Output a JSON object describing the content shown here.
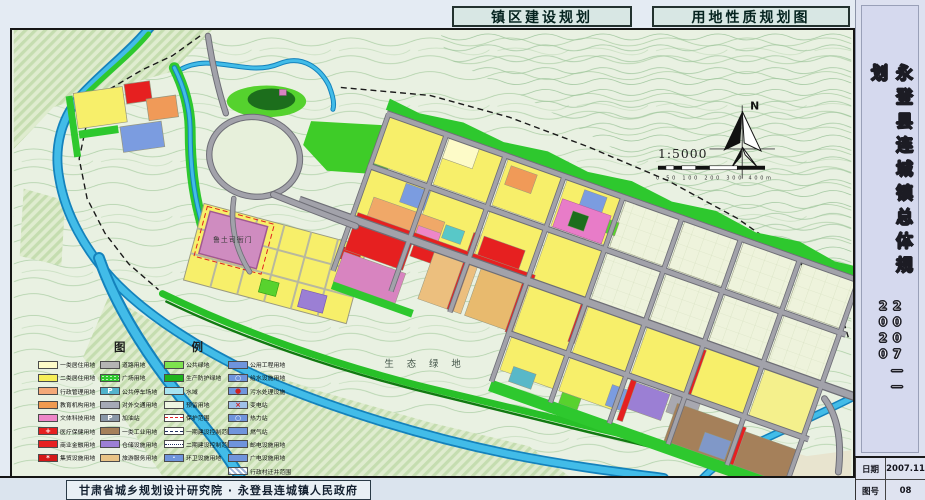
{
  "header": {
    "title_left": "镇区建设规划",
    "title_right": "用地性质规划图"
  },
  "sidebar": {
    "title": "永登县连城镇总体规划",
    "years": "2007——2020",
    "rows": [
      {
        "label": "日期",
        "value": "2007.11"
      },
      {
        "label": "图号",
        "value": "08"
      }
    ]
  },
  "footer": {
    "credit": "甘肃省城乡规划设计研究院 · 永登县连城镇人民政府"
  },
  "map": {
    "landmark_label": "鲁土司衙门",
    "eco_label": "生 态 绿 地",
    "north_label": "N",
    "scale_text": "1:5000",
    "scalebar_labels": "0  50 100    200     300     400m"
  },
  "palette": {
    "water": "#42bce8",
    "road": "#a2a2aa",
    "protective_green": "#2ec82e",
    "residential_yellow": "#f7ef6a",
    "commercial_red": "#e62020",
    "terrain": "#e9f1e2"
  },
  "legend": {
    "title": "图    例",
    "columns": [
      [
        {
          "label": "一类居住用地",
          "color": "#fdfbc8"
        },
        {
          "label": "二类居住用地",
          "color": "#f6ee58"
        },
        {
          "label": "行政管理用地",
          "color": "#f4a878"
        },
        {
          "label": "教育机构用地",
          "color": "#f09a50"
        },
        {
          "label": "文体科技用地",
          "color": "#ee86c8"
        },
        {
          "label": "医疗保健用地",
          "color": "#e62020",
          "sym": "+",
          "symColor": "#ffffff"
        },
        {
          "label": "商业金融用地",
          "color": "#e62020"
        },
        {
          "label": "集贸设施用地",
          "color": "#d41818",
          "sym": "*",
          "symColor": "#ffffff"
        }
      ],
      [
        {
          "label": "道路用地",
          "color": "#b4b4b4"
        },
        {
          "label": "广场用地",
          "color": "#2ec82e",
          "dots": true
        },
        {
          "label": "公共停车场地",
          "color": "#52b4cc",
          "sym": "P",
          "symColor": "#ffffff"
        },
        {
          "label": "对外交通用地",
          "color": "#a6aab6"
        },
        {
          "label": "加油站",
          "color": "#8a97a8",
          "sym": "P",
          "symColor": "#ffffff"
        },
        {
          "label": "一类工业用地",
          "color": "#a5805a"
        },
        {
          "label": "仓储设施用地",
          "color": "#9b7fd4"
        },
        {
          "label": "旅游服务用地",
          "color": "#e9c387"
        }
      ],
      [
        {
          "label": "公共绿地",
          "color": "#7ee24e"
        },
        {
          "label": "生产防护绿地",
          "color": "#1eb41e"
        },
        {
          "label": "水域",
          "color": "#a8e4f0"
        },
        {
          "label": "预留用地",
          "color": "#eef6e2"
        },
        {
          "label": "保护范围",
          "type": "line",
          "lineStyle": "dashed",
          "lineColor": "#e02020"
        },
        {
          "label": "一期建设控制范围",
          "type": "line",
          "lineStyle": "dashed",
          "lineColor": "#203060"
        },
        {
          "label": "二期建设控制范围",
          "type": "line",
          "lineStyle": "dotted",
          "lineColor": "#203060"
        },
        {
          "label": "环卫设施用地",
          "color": "#6f94dc",
          "sym": "·",
          "symColor": "#ffffff"
        }
      ],
      [
        {
          "label": "公用工程用地",
          "color": "#6f94dc"
        },
        {
          "label": "给水设施用地",
          "color": "#6f94dc",
          "sym": "○",
          "symColor": "#ffffff"
        },
        {
          "label": "污水处理设施",
          "color": "#6f94dc",
          "sym": "●",
          "symColor": "#d02020"
        },
        {
          "label": "变电站",
          "color": "#9fc0e8",
          "sym": "×",
          "symColor": "#d02020"
        },
        {
          "label": "热力站",
          "color": "#6f94dc",
          "sym": "○",
          "symColor": "#ffffff"
        },
        {
          "label": "燃气站",
          "color": "#6f94dc"
        },
        {
          "label": "邮电设施用地",
          "color": "#6f94dc"
        },
        {
          "label": "广电设施用地",
          "color": "#6f94dc"
        },
        {
          "label": "行政村迁并范围",
          "color": "#9fb4d8",
          "type": "hatchswatch"
        }
      ]
    ]
  }
}
